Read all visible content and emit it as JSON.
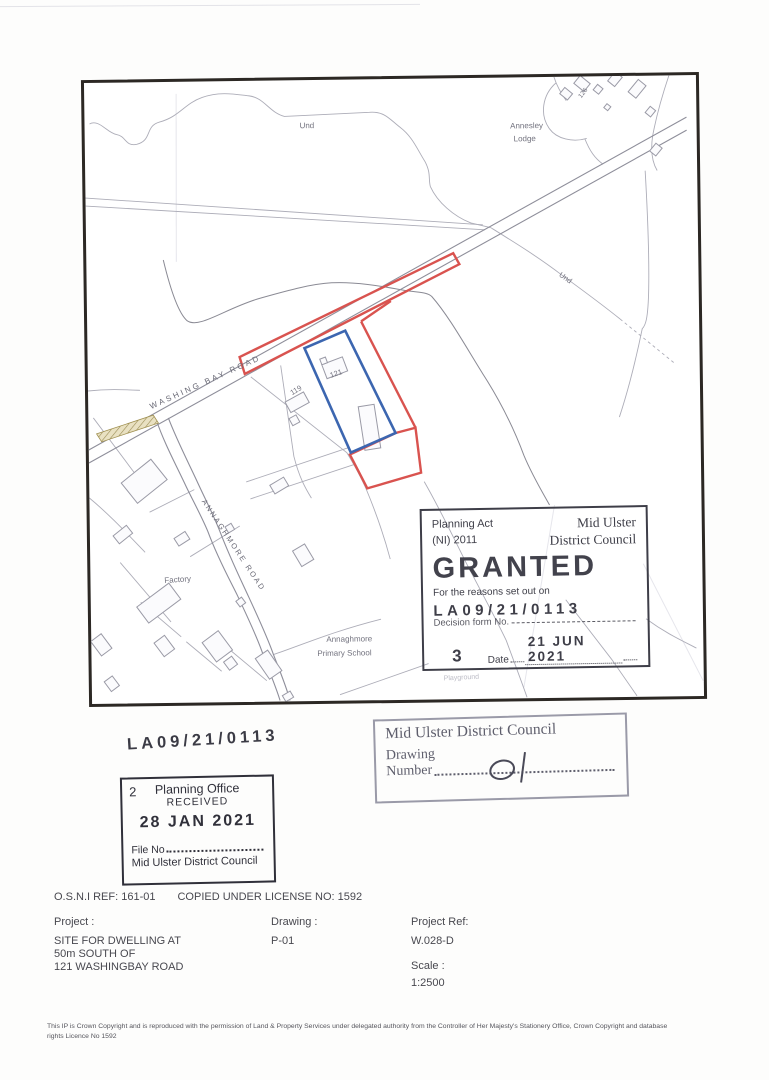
{
  "map": {
    "labels": {
      "und1": "Und",
      "und2": "Und",
      "annesley_line1": "Annesley",
      "annesley_line2": "Lodge",
      "number_126": "126",
      "washing_bay_road": "WASHING BAY ROAD",
      "annaghmore_road": "ANNAGHMORE ROAD",
      "number_119": "119",
      "number_121": "121",
      "factory": "Factory",
      "school_line1": "Annaghmore",
      "school_line2": "Primary School",
      "playground": "Playground"
    },
    "colors": {
      "application_boundary_red": "#d9534f",
      "curtilage_blue": "#3c66b0"
    }
  },
  "granted_stamp": {
    "act_line1": "Planning Act",
    "act_line2": "(NI) 2011",
    "council_line1": "Mid Ulster",
    "council_line2": "District Council",
    "title": "GRANTED",
    "reasons": "For the reasons set out on",
    "reference": "LA09/21/0113",
    "decision_form_label": "Decision form No.",
    "decision_number": "3",
    "date_label": "Date",
    "date_value": "21 JUN 2021"
  },
  "reference_stamp": {
    "value": "LA09/21/0113"
  },
  "received_stamp": {
    "corner_number": "2",
    "office": "Planning Office",
    "received": "RECEIVED",
    "date": "28 JAN 2021",
    "file_no_label": "File No",
    "council": "Mid Ulster District Council"
  },
  "drawing_stamp": {
    "council": "Mid Ulster District Council",
    "drawing_label": "Drawing",
    "number_label": "Number",
    "handwritten_number": "01"
  },
  "footer": {
    "osni_ref": "O.S.N.I REF: 161-01",
    "license": "COPIED UNDER LICENSE NO: 1592",
    "project_label": "Project :",
    "project_line1": "SITE FOR DWELLING AT",
    "project_line2": "50m SOUTH OF",
    "project_line3": "121 WASHINGBAY ROAD",
    "drawing_label": "Drawing :",
    "drawing_value": "P-01",
    "project_ref_label": "Project Ref:",
    "project_ref_value": "W.028-D",
    "scale_label": "Scale :",
    "scale_value": "1:2500"
  },
  "copyright": {
    "line1": "This IP is Crown Copyright and is reproduced with the permission of Land & Property Services under delegated authority from the Controller of Her Majesty's Stationery Office, Crown Copyright and database",
    "line2": "rights Licence No 1592"
  }
}
